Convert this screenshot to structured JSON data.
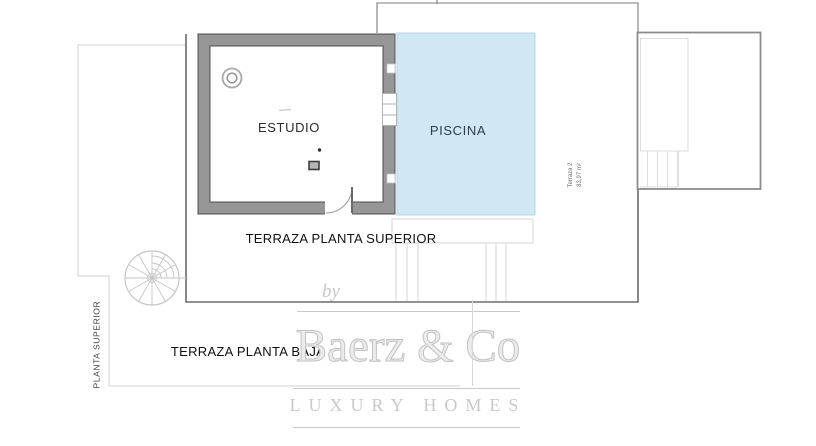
{
  "plan": {
    "estudio_label": "ESTUDIO",
    "piscina_label": "PISCINA",
    "terraza_superior_label": "TERRAZA PLANTA SUPERIOR",
    "terraza_baja_label": "TERRAZA PLANTA BAJA",
    "planta_superior_label": "PLANTA SUPERIOR",
    "terraza2": {
      "name": "Terraza 2",
      "area": "83,97 m²"
    },
    "colors": {
      "pool_fill": "#cfe8f4",
      "pool_border": "#b7d6e5",
      "wall_fill": "#969696",
      "wall_edge": "#4f4f4f",
      "line": "#6b6b6b",
      "line_thin": "#7c7c7c",
      "light_line": "#d9d9d9"
    }
  },
  "watermark": {
    "by_label": "by",
    "brand_label": "Baerz & Co",
    "tagline_label": "LUXURY HOMES",
    "color": "#c9c9c9"
  }
}
